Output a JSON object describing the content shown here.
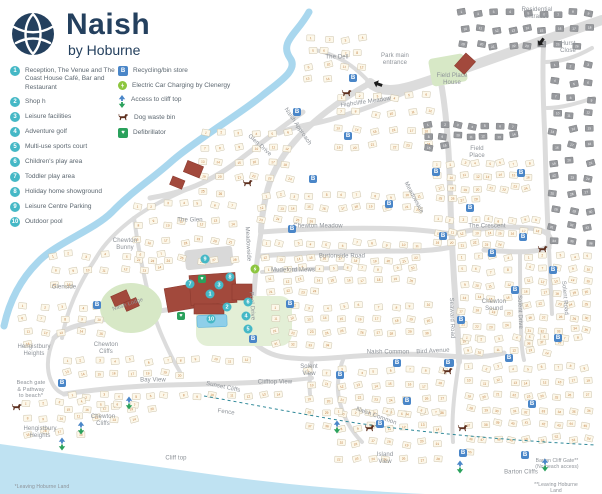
{
  "logo": {
    "title": "Naish",
    "subtitle": "by Hoburne"
  },
  "legend": {
    "numbered": [
      {
        "num": "1",
        "label": "Reception, The Venue and The Coast House Café, Bar and Restaurant"
      },
      {
        "num": "2",
        "label": "Shop h"
      },
      {
        "num": "3",
        "label": "Leisure facilities"
      },
      {
        "num": "4",
        "label": "Adventure golf"
      },
      {
        "num": "5",
        "label": "Multi-use sports court"
      },
      {
        "num": "6",
        "label": "Children's play area"
      },
      {
        "num": "7",
        "label": "Toddler play area"
      },
      {
        "num": "8",
        "label": "Holiday home showground"
      },
      {
        "num": "9",
        "label": "Leisure Centre Parking"
      },
      {
        "num": "10",
        "label": "Outdoor pool"
      }
    ],
    "icons": [
      {
        "icon": "recycling",
        "label": "Recycling/bin store"
      },
      {
        "icon": "ev-charging",
        "label": "Electric Car Charging by Clenergy"
      },
      {
        "icon": "cliff-access",
        "label": "Access to cliff top"
      },
      {
        "icon": "dog-waste",
        "label": "Dog waste bin"
      },
      {
        "icon": "defibrillator",
        "label": "Defibrillator"
      }
    ]
  },
  "colors": {
    "brand_navy": "#24405e",
    "marker_teal": "#45b8c6",
    "recycling_blue": "#4a86c8",
    "ev_green": "#8dc63f",
    "defib_green": "#2aa15c",
    "dog_brown": "#5d2f1e",
    "plot_cream": "#fdf8ea",
    "residential_grey": "#97999d",
    "building_red": "#a2493c",
    "water_blue": "#bfe2f2",
    "road_grey": "#dcdcdc",
    "label_grey": "#8d9298"
  },
  "map": {
    "labels": [
      {
        "text": "Residential\nentrance",
        "x": 537,
        "y": 14
      },
      {
        "text": "Park main\nentrance",
        "x": 395,
        "y": 60
      },
      {
        "text": "The Dell",
        "x": 337,
        "y": 58
      },
      {
        "text": "Hurst\nClose",
        "x": 568,
        "y": 48
      },
      {
        "text": "Field Place\nHouse",
        "x": 452,
        "y": 80
      },
      {
        "text": "Highcliffe Meadow",
        "x": 366,
        "y": 103,
        "rot": -8
      },
      {
        "text": "Naish Approach",
        "x": 297,
        "y": 127,
        "rot": 56
      },
      {
        "text": "Glen Drive",
        "x": 259,
        "y": 146,
        "rot": 42
      },
      {
        "text": "The Glen",
        "x": 190,
        "y": 221
      },
      {
        "text": "Chewton\nBunny",
        "x": 125,
        "y": 245
      },
      {
        "text": "Meadowside",
        "x": 247,
        "y": 244,
        "rot": 87
      },
      {
        "text": "Meadowside",
        "x": 413,
        "y": 198,
        "rot": 62
      },
      {
        "text": "Chewton Meadow",
        "x": 318,
        "y": 227
      },
      {
        "text": "Burtonside Road",
        "x": 342,
        "y": 257
      },
      {
        "text": "Mudeford Mews",
        "x": 293,
        "y": 271
      },
      {
        "text": "Pool Drive",
        "x": 251,
        "y": 306,
        "rot": 86
      },
      {
        "text": "Field\nPlace",
        "x": 477,
        "y": 153
      },
      {
        "text": "The Crescent",
        "x": 487,
        "y": 227
      },
      {
        "text": "Chewton\nSound",
        "x": 494,
        "y": 306
      },
      {
        "text": "Seaward Road",
        "x": 451,
        "y": 318,
        "rot": 88
      },
      {
        "text": "Solent Drive",
        "x": 519,
        "y": 312,
        "rot": 88
      },
      {
        "text": "Solent Road",
        "x": 564,
        "y": 298,
        "rot": 85
      },
      {
        "text": "Solent\nView",
        "x": 309,
        "y": 371
      },
      {
        "text": "Naish Common",
        "x": 388,
        "y": 353
      },
      {
        "text": "Bird Avenue",
        "x": 433,
        "y": 352,
        "rot": -3
      },
      {
        "text": "Naish Common",
        "x": 376,
        "y": 417,
        "rot": 20
      },
      {
        "text": "Island\nView",
        "x": 385,
        "y": 459
      },
      {
        "text": "Barton Cliffs",
        "x": 521,
        "y": 473
      },
      {
        "text": "Barton Cliff Gate**\n(No beach access)",
        "x": 557,
        "y": 464,
        "size": 5
      },
      {
        "text": "**Leaving Hoburne Land",
        "x": 556,
        "y": 488,
        "size": 5
      },
      {
        "text": "*Leaving Hoburne Land",
        "x": 42,
        "y": 487,
        "size": 5
      },
      {
        "text": "Cliff top",
        "x": 176,
        "y": 459
      },
      {
        "text": "Fence",
        "x": 226,
        "y": 413,
        "rot": 8
      },
      {
        "text": "Bay View",
        "x": 153,
        "y": 381
      },
      {
        "text": "Sunset Cliffs",
        "x": 223,
        "y": 388,
        "rot": 12
      },
      {
        "text": "Clifftop View",
        "x": 275,
        "y": 383
      },
      {
        "text": "Chewton\nCliffs",
        "x": 103,
        "y": 421
      },
      {
        "text": "Hengistbury\nHeights",
        "x": 40,
        "y": 433
      },
      {
        "text": "Hengistbury\nHeights",
        "x": 34,
        "y": 351
      },
      {
        "text": "Chewton\nCliffs",
        "x": 106,
        "y": 349
      },
      {
        "text": "Glenside",
        "x": 64,
        "y": 288
      },
      {
        "text": "Beach gate\n& Pathway\nto beach*",
        "x": 31,
        "y": 390,
        "size": 5.5
      },
      {
        "text": "Naish Lodge",
        "x": 128,
        "y": 305,
        "rot": -18,
        "size": 5.5
      }
    ],
    "numbered_markers": [
      {
        "num": "1",
        "x": 210,
        "y": 294
      },
      {
        "num": "2",
        "x": 227,
        "y": 307
      },
      {
        "num": "3",
        "x": 219,
        "y": 285
      },
      {
        "num": "4",
        "x": 246,
        "y": 316
      },
      {
        "num": "5",
        "x": 248,
        "y": 329
      },
      {
        "num": "6",
        "x": 248,
        "y": 302
      },
      {
        "num": "7",
        "x": 190,
        "y": 284
      },
      {
        "num": "8",
        "x": 230,
        "y": 277
      },
      {
        "num": "9",
        "x": 205,
        "y": 259
      },
      {
        "num": "10",
        "x": 211,
        "y": 319
      }
    ],
    "recycling_points": [
      {
        "x": 353,
        "y": 78
      },
      {
        "x": 297,
        "y": 112
      },
      {
        "x": 348,
        "y": 136
      },
      {
        "x": 313,
        "y": 179
      },
      {
        "x": 389,
        "y": 204
      },
      {
        "x": 292,
        "y": 229
      },
      {
        "x": 290,
        "y": 304
      },
      {
        "x": 253,
        "y": 339
      },
      {
        "x": 436,
        "y": 172
      },
      {
        "x": 521,
        "y": 173
      },
      {
        "x": 470,
        "y": 208
      },
      {
        "x": 443,
        "y": 236
      },
      {
        "x": 523,
        "y": 237
      },
      {
        "x": 492,
        "y": 253
      },
      {
        "x": 553,
        "y": 270
      },
      {
        "x": 515,
        "y": 290
      },
      {
        "x": 461,
        "y": 320
      },
      {
        "x": 558,
        "y": 338
      },
      {
        "x": 509,
        "y": 358
      },
      {
        "x": 450,
        "y": 363
      },
      {
        "x": 340,
        "y": 375
      },
      {
        "x": 397,
        "y": 363
      },
      {
        "x": 448,
        "y": 363
      },
      {
        "x": 407,
        "y": 401
      },
      {
        "x": 380,
        "y": 424
      },
      {
        "x": 463,
        "y": 453
      },
      {
        "x": 525,
        "y": 455
      },
      {
        "x": 532,
        "y": 404
      },
      {
        "x": 97,
        "y": 305
      },
      {
        "x": 62,
        "y": 383
      }
    ],
    "dog_waste_bins": [
      {
        "x": 347,
        "y": 93
      },
      {
        "x": 248,
        "y": 183
      },
      {
        "x": 543,
        "y": 249
      },
      {
        "x": 448,
        "y": 371
      },
      {
        "x": 370,
        "y": 428
      },
      {
        "x": 463,
        "y": 428
      },
      {
        "x": 17,
        "y": 407
      }
    ],
    "defibrillators": [
      {
        "x": 202,
        "y": 279
      },
      {
        "x": 181,
        "y": 316
      }
    ],
    "ev_charging": [
      {
        "x": 255,
        "y": 269
      }
    ],
    "cliff_access": [
      {
        "x": 129,
        "y": 403
      },
      {
        "x": 81,
        "y": 428
      },
      {
        "x": 62,
        "y": 444
      },
      {
        "x": 337,
        "y": 427
      },
      {
        "x": 460,
        "y": 467
      },
      {
        "x": 545,
        "y": 465
      }
    ],
    "entrance_arrows": [
      {
        "x": 378,
        "y": 84,
        "rot": 200
      },
      {
        "x": 541,
        "y": 42,
        "rot": 125
      }
    ],
    "plot_clusters": [
      {
        "x": 302,
        "y": 32,
        "w": 66,
        "h": 54,
        "n": 14
      },
      {
        "x": 196,
        "y": 126,
        "w": 100,
        "h": 74,
        "n": 26
      },
      {
        "x": 330,
        "y": 88,
        "w": 108,
        "h": 66,
        "n": 24
      },
      {
        "x": 432,
        "y": 158,
        "w": 102,
        "h": 48,
        "n": 28
      },
      {
        "x": 128,
        "y": 196,
        "w": 112,
        "h": 72,
        "n": 28
      },
      {
        "x": 256,
        "y": 190,
        "w": 172,
        "h": 36,
        "n": 26
      },
      {
        "x": 258,
        "y": 236,
        "w": 168,
        "h": 32,
        "n": 22
      },
      {
        "x": 262,
        "y": 262,
        "w": 158,
        "h": 36,
        "n": 24
      },
      {
        "x": 268,
        "y": 300,
        "w": 168,
        "h": 52,
        "n": 34
      },
      {
        "x": 432,
        "y": 214,
        "w": 112,
        "h": 36,
        "n": 24
      },
      {
        "x": 44,
        "y": 248,
        "w": 126,
        "h": 42,
        "n": 16
      },
      {
        "x": 456,
        "y": 250,
        "w": 58,
        "h": 96,
        "n": 26
      },
      {
        "x": 520,
        "y": 250,
        "w": 76,
        "h": 98,
        "n": 38
      },
      {
        "x": 458,
        "y": 332,
        "w": 128,
        "h": 26,
        "n": 14
      },
      {
        "x": 302,
        "y": 364,
        "w": 148,
        "h": 70,
        "n": 38
      },
      {
        "x": 332,
        "y": 404,
        "w": 112,
        "h": 62,
        "n": 28
      },
      {
        "x": 462,
        "y": 360,
        "w": 132,
        "h": 100,
        "n": 55
      },
      {
        "x": 58,
        "y": 354,
        "w": 198,
        "h": 26,
        "n": 20,
        "rot": -4
      },
      {
        "x": 62,
        "y": 390,
        "w": 224,
        "h": 24,
        "n": 20,
        "rot": -4
      },
      {
        "x": 16,
        "y": 300,
        "w": 92,
        "h": 52,
        "n": 16
      },
      {
        "x": 16,
        "y": 396,
        "w": 128,
        "h": 44,
        "n": 18
      },
      {
        "x": 456,
        "y": 6,
        "w": 142,
        "h": 46,
        "n": 26,
        "style": "residential"
      },
      {
        "x": 546,
        "y": 58,
        "w": 52,
        "h": 192,
        "n": 36,
        "style": "residential"
      },
      {
        "x": 422,
        "y": 120,
        "w": 98,
        "h": 32,
        "n": 16,
        "style": "residential"
      }
    ]
  }
}
